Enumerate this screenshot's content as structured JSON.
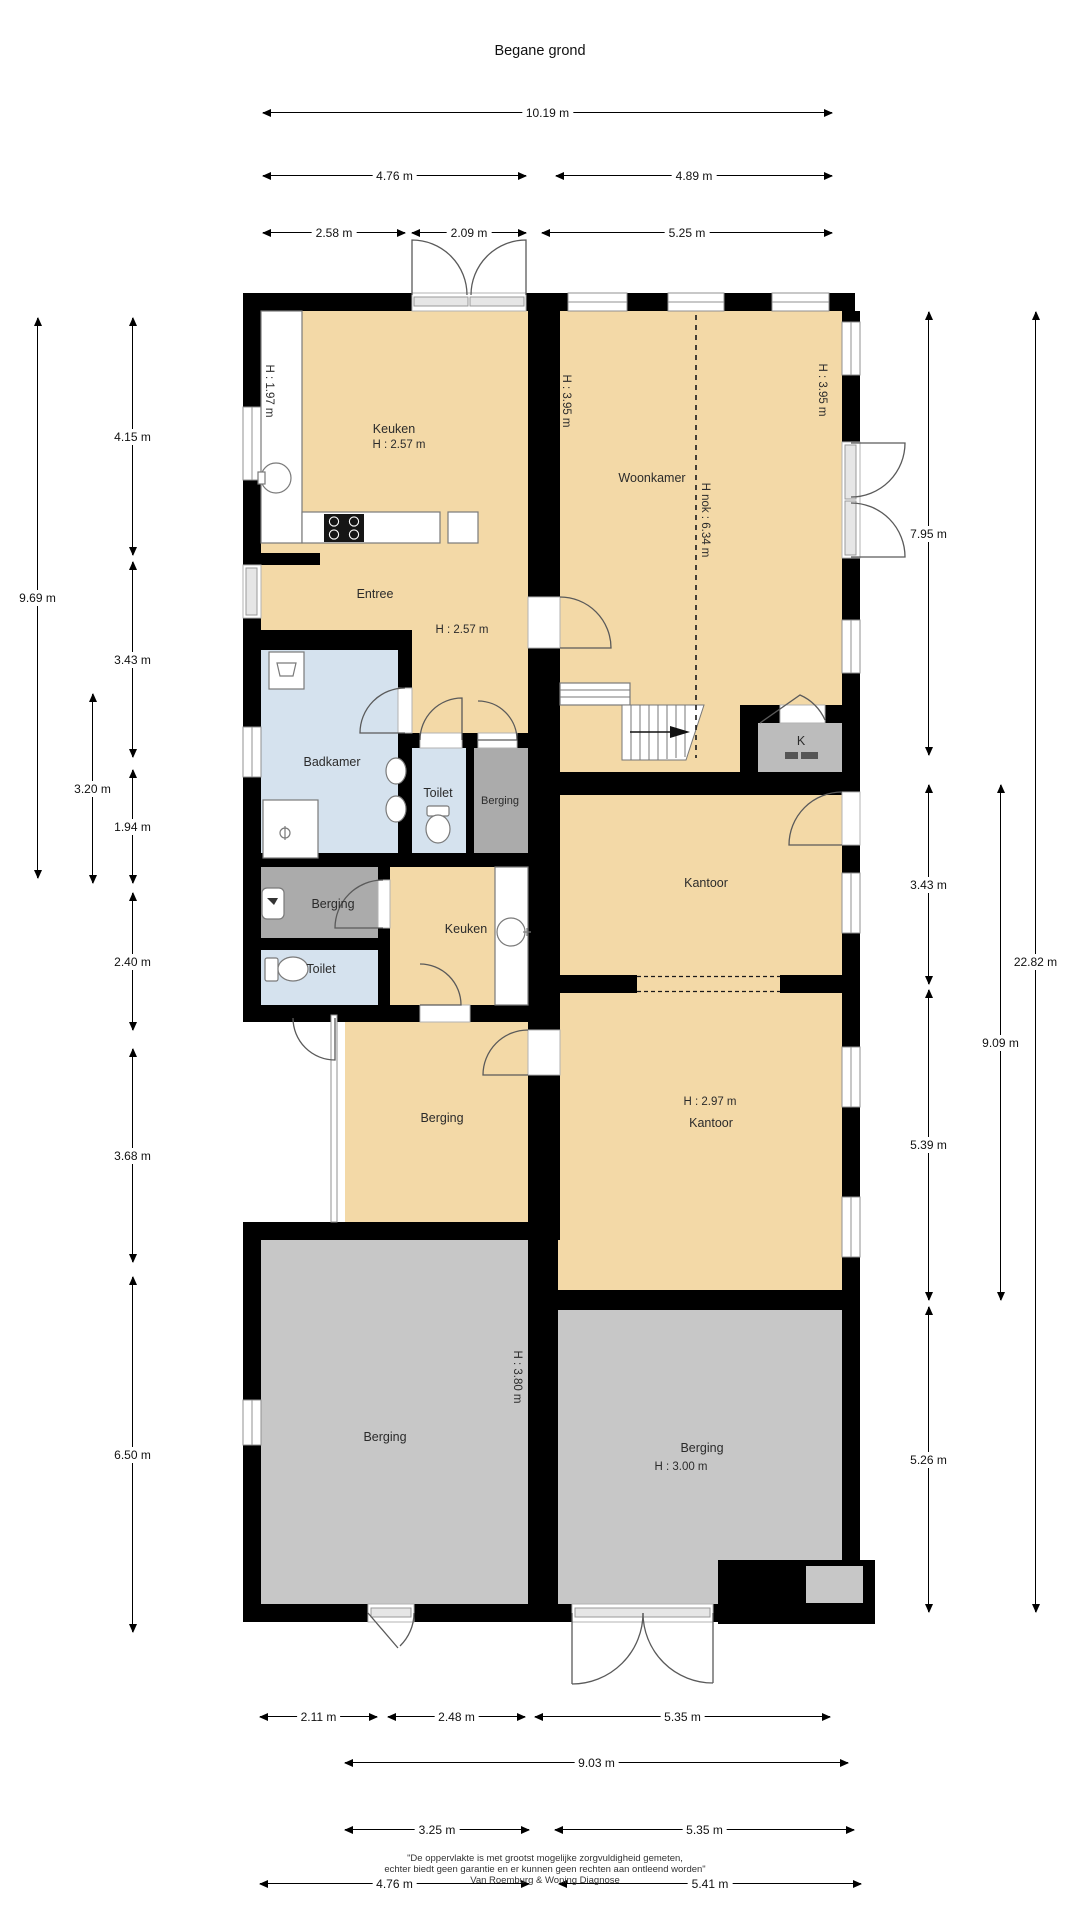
{
  "title": "Begane grond",
  "rooms": {
    "keuken1": {
      "name": "Keuken",
      "height": "H : 2.57 m"
    },
    "woonkamer": {
      "name": "Woonkamer",
      "ridge": "H nok : 6.34 m"
    },
    "entree": {
      "name": "Entree",
      "height": "H : 2.57 m"
    },
    "badkamer": {
      "name": "Badkamer"
    },
    "toilet1": {
      "name": "Toilet"
    },
    "berging_small": {
      "name": "Berging"
    },
    "kast": {
      "name": "K"
    },
    "kantoor1": {
      "name": "Kantoor"
    },
    "berging_mid": {
      "name": "Berging"
    },
    "keuken2": {
      "name": "Keuken"
    },
    "toilet2": {
      "name": "Toilet"
    },
    "berging_overkapping": {
      "name": "Berging"
    },
    "kantoor2": {
      "name": "Kantoor",
      "height": "H : 2.97 m"
    },
    "berging_left": {
      "name": "Berging",
      "height": "H : 3.80 m"
    },
    "berging_right": {
      "name": "Berging",
      "height": "H : 3.00 m"
    }
  },
  "annotations": {
    "keuken_wall": "H : 1.97 m",
    "woonkamer_wall_left": "H : 3.95 m",
    "woonkamer_wall_right": "H : 3.95 m"
  },
  "dimensions": {
    "top": [
      "10.19 m",
      "4.76 m",
      "4.89 m",
      "2.58 m",
      "2.09 m",
      "5.25 m"
    ],
    "left": [
      "9.69 m",
      "4.15 m",
      "3.43 m",
      "3.20 m",
      "1.94 m",
      "2.40 m",
      "3.68 m",
      "6.50 m"
    ],
    "right": [
      "7.95 m",
      "3.43 m",
      "5.39 m",
      "5.26 m",
      "9.09 m",
      "22.82 m"
    ],
    "bottom": [
      "2.11 m",
      "2.48 m",
      "5.35 m",
      "9.03 m",
      "3.25 m",
      "5.35 m",
      "4.76 m",
      "5.41 m"
    ]
  },
  "footer": {
    "line1": "\"De oppervlakte is met grootst mogelijke zorgvuldigheid gemeten,",
    "line2": "echter biedt geen garantie en er kunnen geen rechten aan ontleend worden\"",
    "line3": "Van Roemburg & Woning Diagnose"
  },
  "colors": {
    "room_living": "#f3d9a7",
    "room_wet": "#d5e2ee",
    "room_storage": "#ababab",
    "room_storage_floor": "#c7c7c7",
    "walls": "#000000"
  }
}
